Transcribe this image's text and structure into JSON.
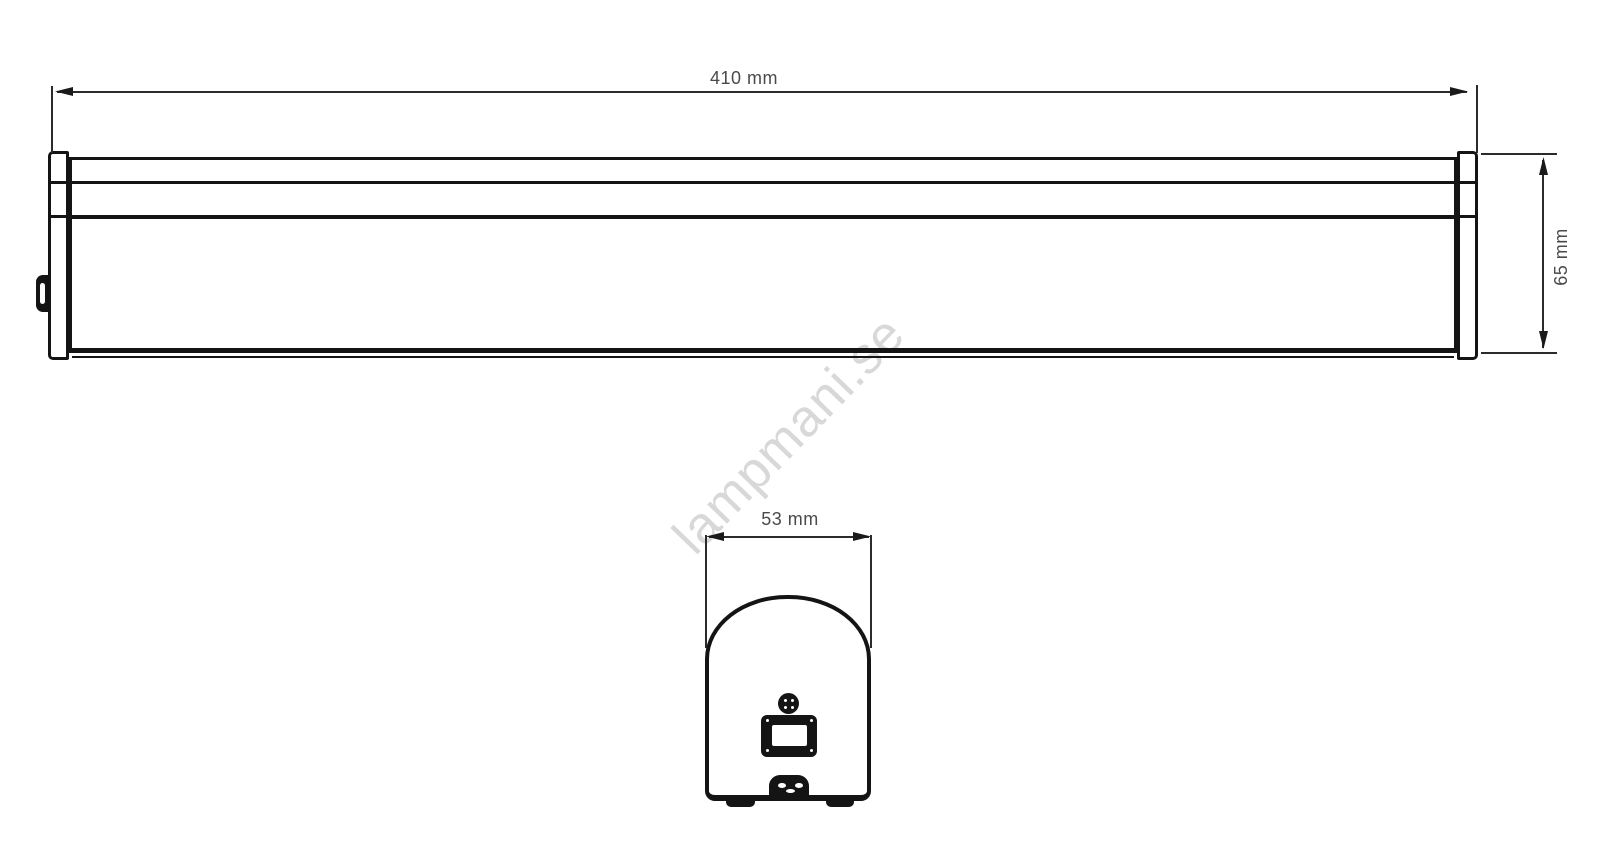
{
  "drawing": {
    "watermark": {
      "text": "lampmani.se"
    },
    "dimensions": {
      "length": {
        "label": "410 mm"
      },
      "height": {
        "label": "65 mm"
      },
      "depth": {
        "label": "53 mm"
      }
    },
    "colors": {
      "outline": "#141414",
      "dimension_line": "#2b2b2b",
      "dimension_text": "#4a4a4a",
      "watermark": "#d8d8d8",
      "background": "#ffffff"
    }
  }
}
